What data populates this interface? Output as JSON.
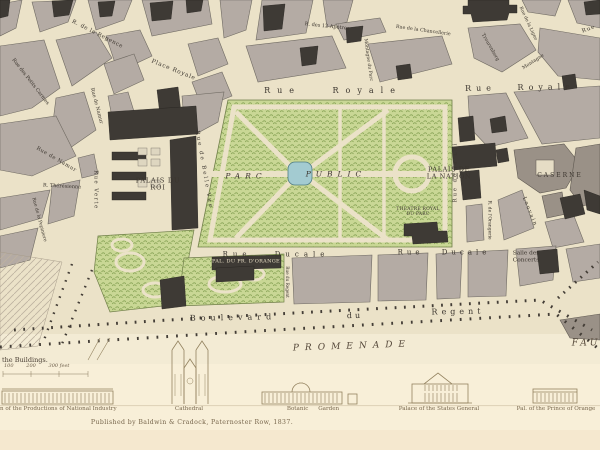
{
  "map_labels": {
    "rue_de_la_regence": "R. de la Regence",
    "place_royale": "Place Royale",
    "rue_des_petits_carmes": "Rue des Petits Carmes",
    "rue_de_namur_upper": "Rue de Namur",
    "rue_de_namur_lower": "Rue de Namur",
    "rue_verte": "Rue Verte",
    "rue_theresienne": "R. Thérésienne",
    "rue_de_la_pepiniere": "Rue de la Pepiniere",
    "rue_de_belle_vue": "Rue de Belle Vue",
    "rue_royale_west": "Rue Royale",
    "rue_royale_east": "Rue Royale",
    "montagne_du_parc": "Montagne du Parc",
    "rue_des_12_apotres": "R. des 12 Apôtres",
    "rue_de_la_chancellerie": "Rue de la Chancellerie",
    "treurenberg": "Treurenberg",
    "rue_de_la_ligne": "Rue de la Ligne",
    "montagne": "Montagne",
    "rue_fragment_ne": "Rue",
    "rue_de_la_loi": "Rue de la Loi",
    "rue_de_l_orangerie": "R. de l'Orangerie",
    "rue_de_louvain": "Louvain",
    "rue_ducale_west": "Rue Ducale",
    "rue_ducale_east": "Rue Ducale",
    "rue_du_regent": "Rue du Regent",
    "boulevard_word": "Boulevard",
    "du_word": "du",
    "regent_word": "Regent",
    "promenade": "PROMENADE",
    "faubourg_fragment": "FAU"
  },
  "places": {
    "parc_word": "PARC",
    "public_word": "PUBLIC",
    "palais_du_roi_l1": "PALAIS DU",
    "palais_du_roi_l2": "ROI",
    "palais_nation_l1": "PALAIS DE",
    "palais_nation_l2": "LA NATION",
    "theatre_l1": "THEATRE ROYAL",
    "theatre_l2": "DU PARC",
    "caserne": "CASERNE",
    "salle_l1": "Salle des",
    "salle_l2": "Concerts",
    "palais_orange": "PAL. DU PR. D'ORANGE"
  },
  "scale": {
    "caption": "the Buildings.",
    "ticks": "100        200        300 feet"
  },
  "vignettes": [
    {
      "caption": "n of the Productions of National Industry"
    },
    {
      "caption": "Cathedral"
    },
    {
      "caption": "Botanic Garden"
    },
    {
      "caption": "Palace of the States General"
    },
    {
      "caption": "Pal. of the Prince of Orange"
    }
  ],
  "imprint": "Published by Baldwin & Cradock, Paternoster Row, 1837.",
  "colors": {
    "paper": "#f7eed6",
    "map_ground": "#ebe2c8",
    "block_gray": "#b4aba4",
    "building_dark": "#3e3a35",
    "park_green": "#c9d795",
    "park_hatch": "#84a052",
    "pond_blue": "#a3cbd1",
    "vignette_sepia": "#93825f",
    "ink": "#3b352e"
  }
}
